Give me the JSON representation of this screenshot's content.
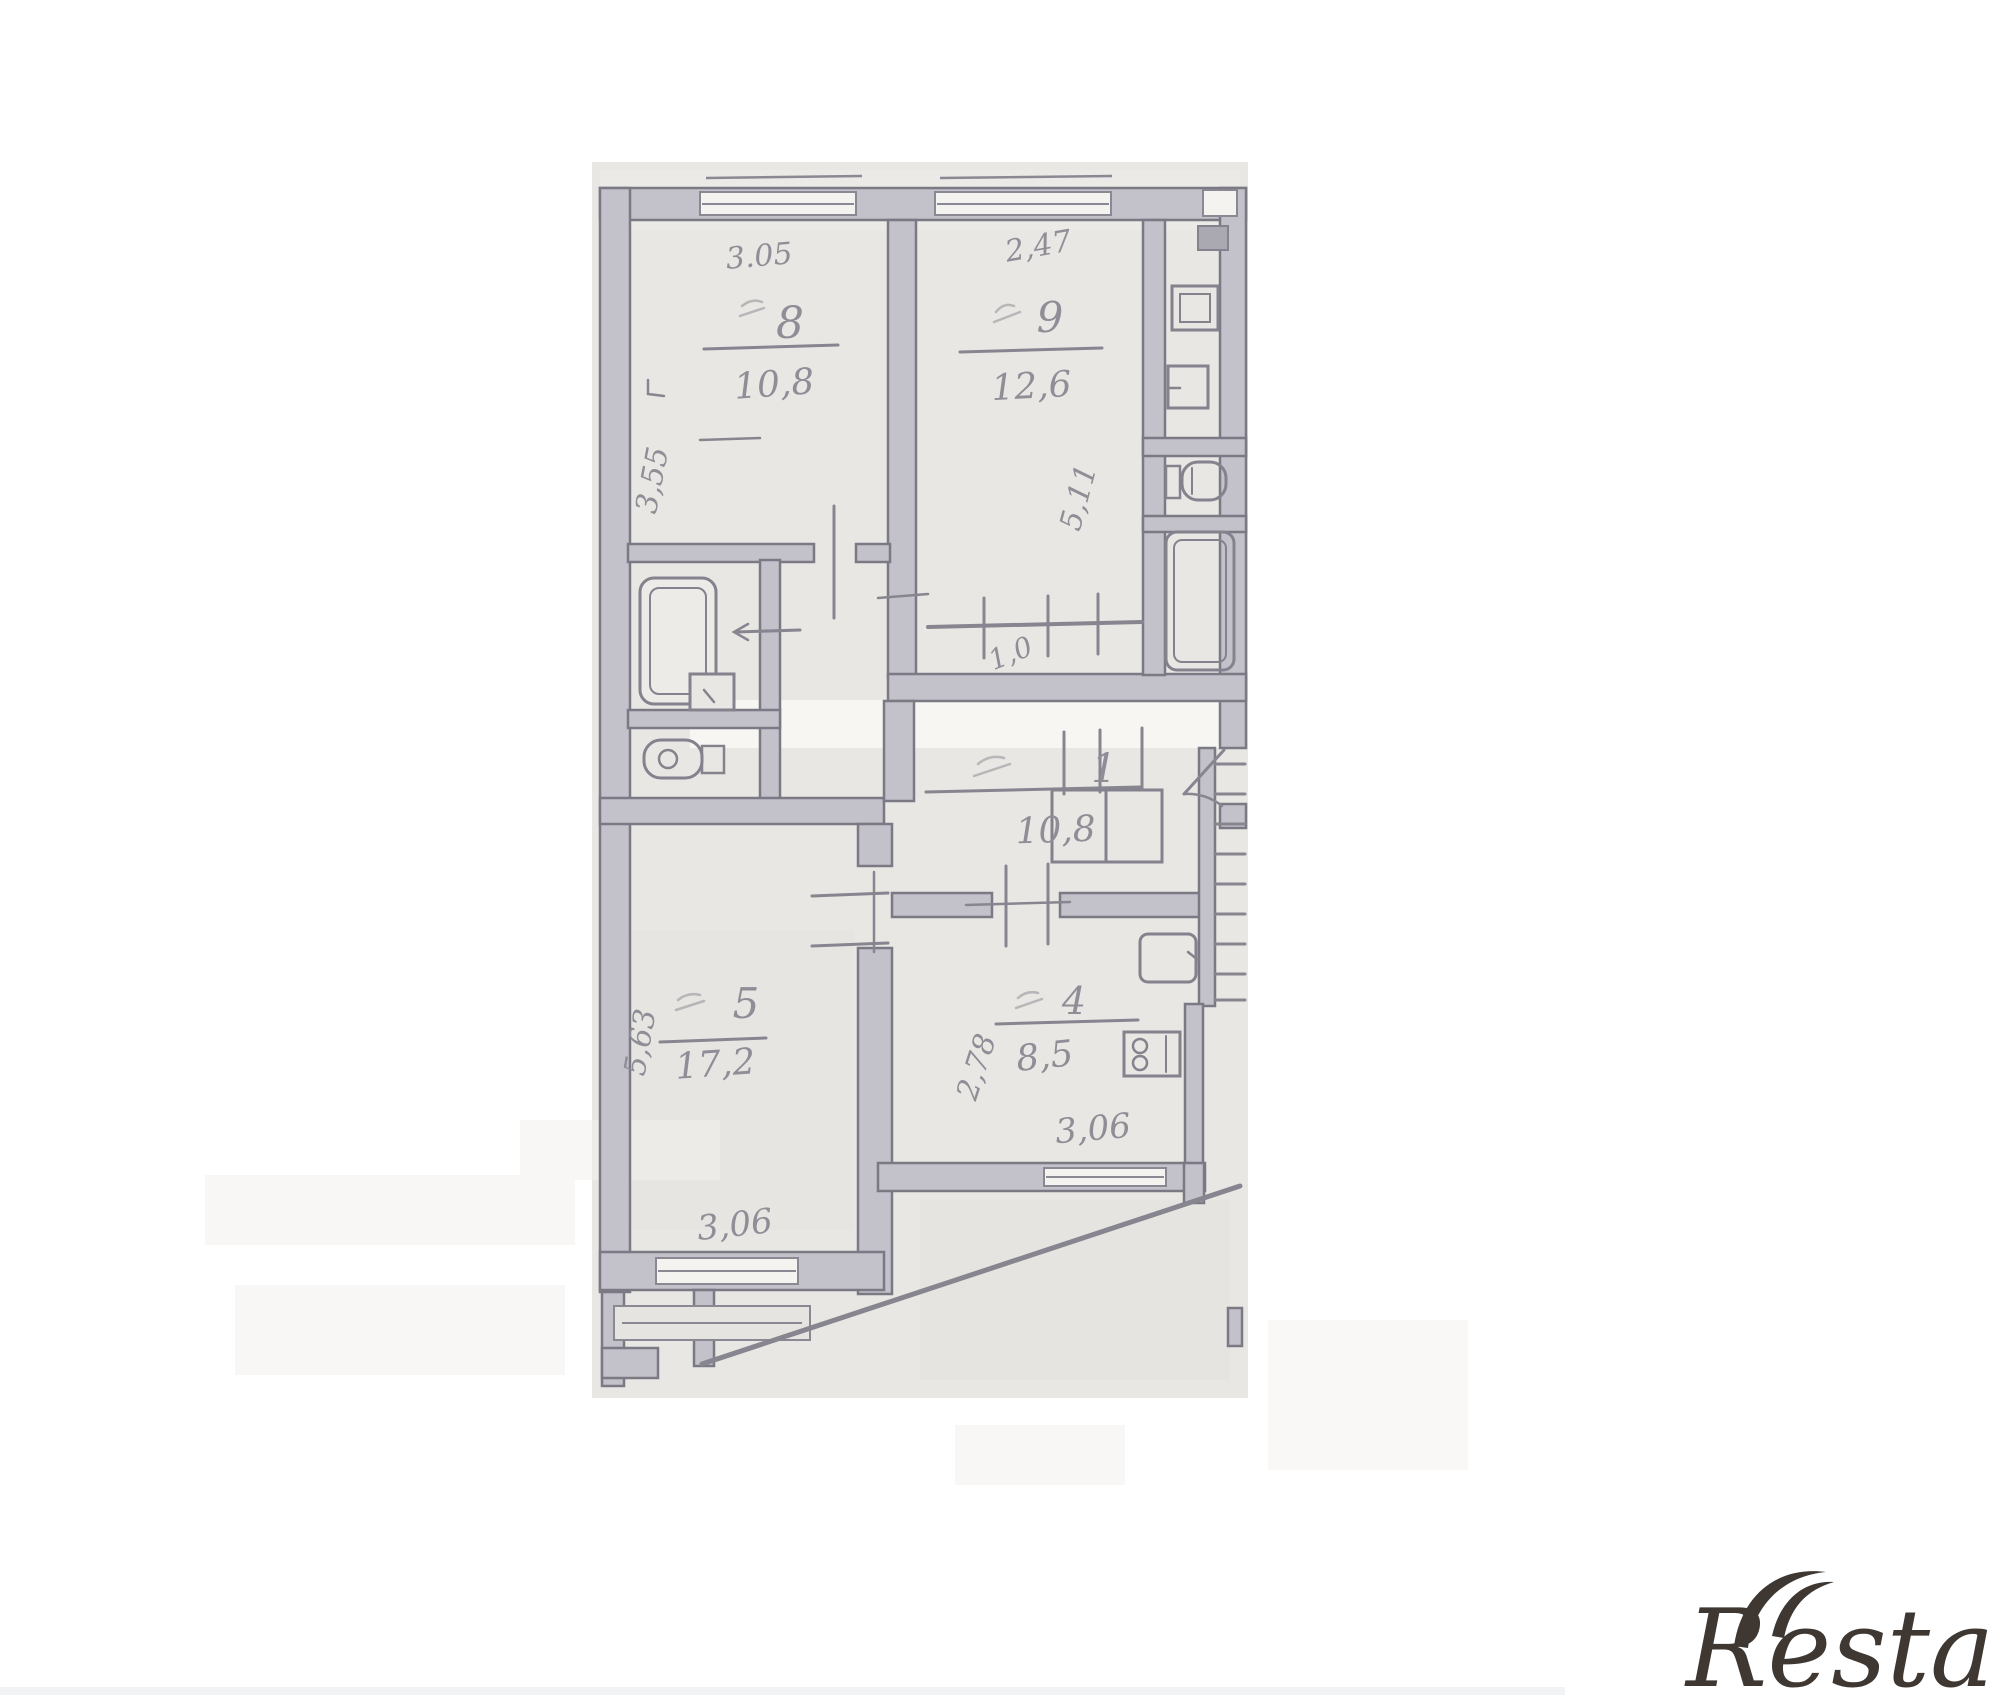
{
  "document": {
    "kind": "scanned apartment floor plan",
    "paper_color": "#e9e7e3",
    "wall_fill": "#c3c1c9",
    "wall_edge": "#7b7984",
    "pencil_ink": "#87858f",
    "handwriting_color": "#8f8d96",
    "logo_color": "#3e3732"
  },
  "floor_plan": {
    "upper_unit": {
      "room_8": {
        "number": "8",
        "area": "10,8",
        "width_m": "3.05",
        "depth_m": "3,55"
      },
      "room_9": {
        "number": "9",
        "area": "12,6",
        "width_m": "2,47",
        "depth_m": "5,11"
      },
      "closet": {
        "area": "1,0"
      }
    },
    "lower_unit": {
      "hall_1": {
        "number": "1",
        "area": "10,8"
      },
      "room_5": {
        "number": "5",
        "area": "17,2",
        "width_m": "3,06",
        "depth_m": "5,63"
      },
      "kitchen_4": {
        "number": "4",
        "area": "8,5",
        "width_m": "3,06",
        "depth_m": "2,78"
      }
    },
    "icons": [
      "bathtub-icon",
      "toilet-icon",
      "sink-icon",
      "stove-icon",
      "vent-shaft-icon",
      "stairs-hatching"
    ]
  },
  "watermark": {
    "brand": "Restate"
  }
}
